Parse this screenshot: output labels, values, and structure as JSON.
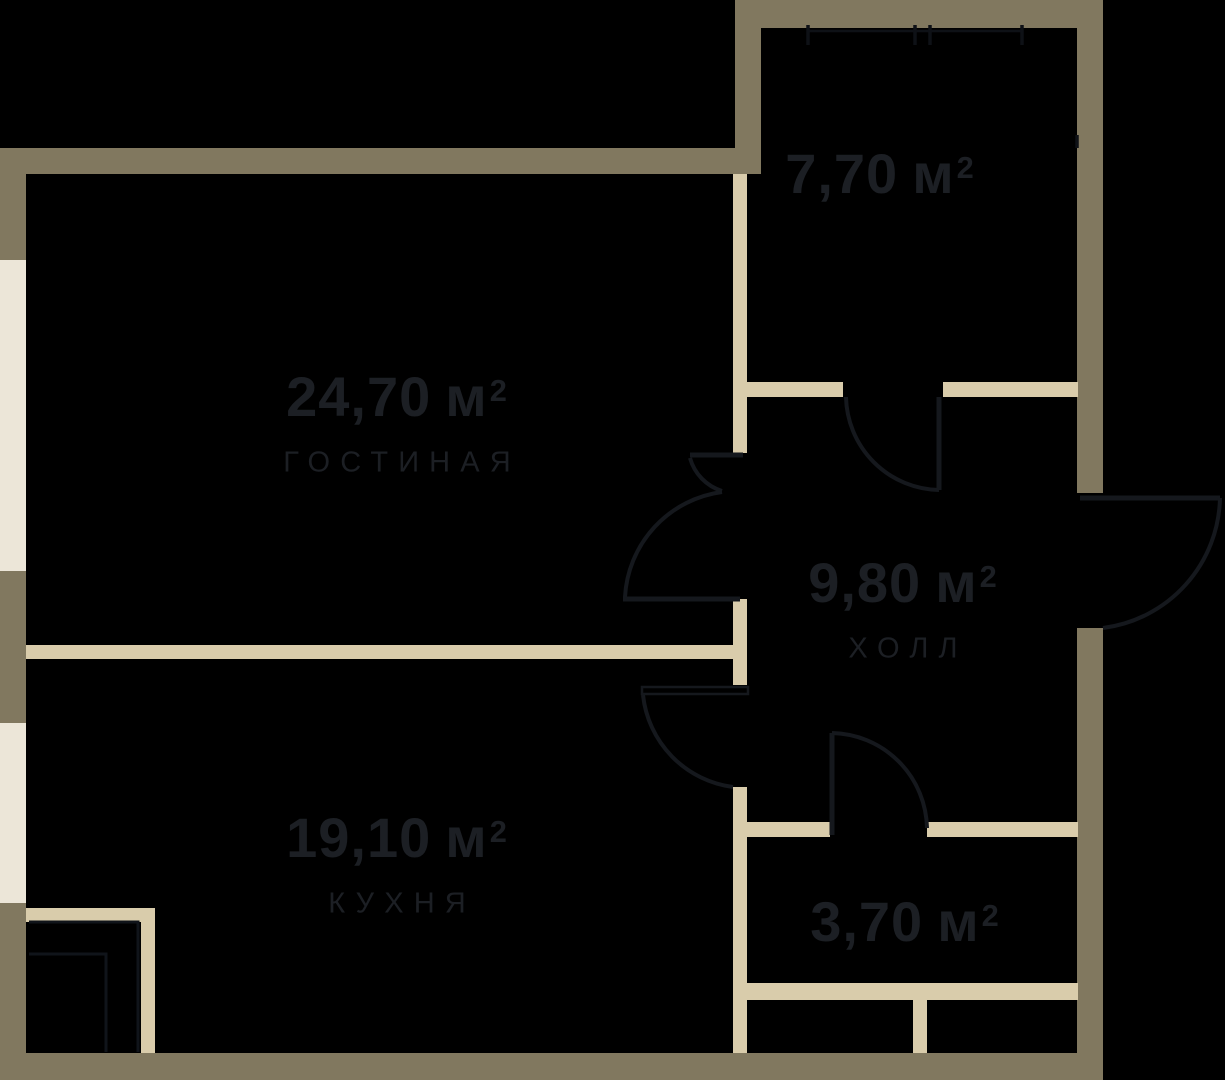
{
  "colors": {
    "bg": "#000000",
    "wall": "#81785F",
    "partition": "#D9CCAB",
    "window": "#ECE6D8",
    "text": "#1C1F24",
    "line": "#15181D"
  },
  "rooms": [
    {
      "id": "living",
      "area": "24,70",
      "unit": "м",
      "sup": "2",
      "name": "гостиная"
    },
    {
      "id": "kitchen",
      "area": "19,10",
      "unit": "м",
      "sup": "2",
      "name": "кухня"
    },
    {
      "id": "hall",
      "area": "9,80",
      "unit": "м",
      "sup": "2",
      "name": "холл"
    },
    {
      "id": "room-770",
      "area": "7,70",
      "unit": "м",
      "sup": "2",
      "name": ""
    },
    {
      "id": "room-370",
      "area": "3,70",
      "unit": "м",
      "sup": "2",
      "name": ""
    }
  ]
}
